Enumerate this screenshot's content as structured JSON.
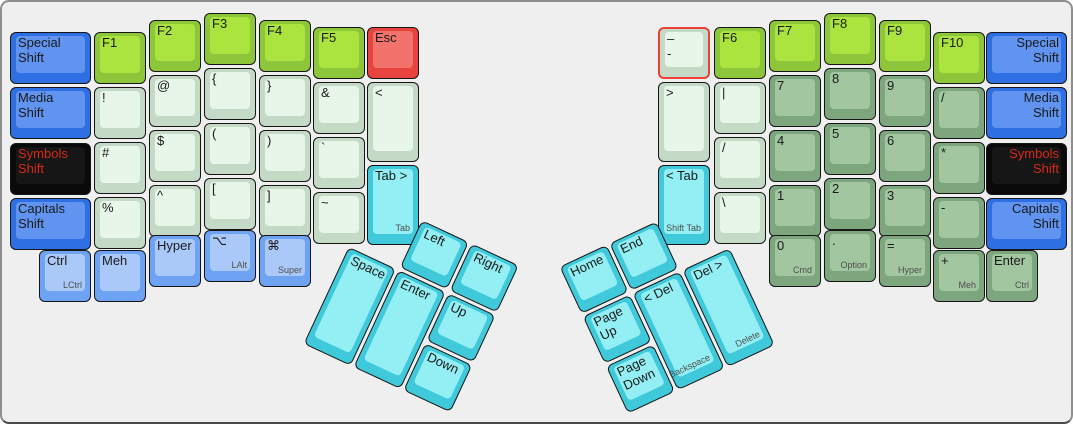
{
  "palette": {
    "fn": {
      "side": "#8dc63a",
      "cap": "#abe43e"
    },
    "pale": {
      "side": "#c5dac6",
      "cap": "#e7f6e9"
    },
    "sage": {
      "side": "#7ea67e",
      "cap": "#a2c7a0"
    },
    "blue": {
      "side": "#2e6fe4",
      "cap": "#6094f0"
    },
    "black": {
      "side": "#0a0a0a",
      "cap": "#161616",
      "text": "#d5291d"
    },
    "red": {
      "side": "#e8433e",
      "cap": "#f2736c"
    },
    "cyan": {
      "side": "#3fc9db",
      "cap": "#93eff3"
    },
    "lightblue": {
      "side": "#6ea3f3",
      "cap": "#abc9f8"
    },
    "selection": "#ee4035",
    "sublegend": "#4d4d4d",
    "canvas_bg": "#efefef"
  },
  "keyboard": {
    "groups": {
      "left_main": [
        {
          "name": "special-shift-left",
          "lines": [
            "Special",
            "Shift"
          ],
          "color": "blue"
        },
        {
          "name": "media-shift-left",
          "lines": [
            "Media",
            "Shift"
          ],
          "color": "blue"
        },
        {
          "name": "symbols-shift-left",
          "lines": [
            "Symbols",
            "Shift"
          ],
          "color": "black"
        },
        {
          "name": "capitals-shift-left",
          "lines": [
            "Capitals",
            "Shift"
          ],
          "color": "blue"
        },
        {
          "name": "f1",
          "lines": [
            "F1"
          ],
          "color": "fn"
        },
        {
          "name": "exclamation",
          "lines": [
            "!"
          ],
          "color": "pale"
        },
        {
          "name": "hash",
          "lines": [
            "#"
          ],
          "color": "pale"
        },
        {
          "name": "percent",
          "lines": [
            "%"
          ],
          "color": "pale"
        },
        {
          "name": "f2",
          "lines": [
            "F2"
          ],
          "color": "fn"
        },
        {
          "name": "at-sign",
          "lines": [
            "@"
          ],
          "color": "pale"
        },
        {
          "name": "dollar",
          "lines": [
            "$"
          ],
          "color": "pale"
        },
        {
          "name": "caret",
          "lines": [
            "^"
          ],
          "color": "pale"
        },
        {
          "name": "f3",
          "lines": [
            "F3"
          ],
          "color": "fn"
        },
        {
          "name": "brace-open",
          "lines": [
            "{"
          ],
          "color": "pale"
        },
        {
          "name": "paren-open",
          "lines": [
            "("
          ],
          "color": "pale"
        },
        {
          "name": "bracket-open",
          "lines": [
            "["
          ],
          "color": "pale"
        },
        {
          "name": "f4",
          "lines": [
            "F4"
          ],
          "color": "fn"
        },
        {
          "name": "brace-close",
          "lines": [
            "}"
          ],
          "color": "pale"
        },
        {
          "name": "paren-close",
          "lines": [
            ")"
          ],
          "color": "pale"
        },
        {
          "name": "bracket-close",
          "lines": [
            "]"
          ],
          "color": "pale"
        },
        {
          "name": "f5",
          "lines": [
            "F5"
          ],
          "color": "fn"
        },
        {
          "name": "ampersand",
          "lines": [
            "&"
          ],
          "color": "pale"
        },
        {
          "name": "backtick",
          "lines": [
            "`"
          ],
          "color": "pale"
        },
        {
          "name": "tilde",
          "lines": [
            "~"
          ],
          "color": "pale"
        },
        {
          "name": "esc",
          "lines": [
            "Esc"
          ],
          "color": "red"
        },
        {
          "name": "less-than",
          "lines": [
            "<"
          ],
          "color": "pale"
        },
        {
          "name": "tab",
          "lines": [
            "Tab >"
          ],
          "sub": "Tab",
          "color": "cyan"
        },
        {
          "name": "lctrl",
          "lines": [
            "Ctrl"
          ],
          "sub": "LCtrl",
          "color": "lightblue"
        },
        {
          "name": "meh",
          "lines": [
            "Meh"
          ],
          "color": "lightblue"
        },
        {
          "name": "hyper",
          "lines": [
            "Hyper"
          ],
          "color": "lightblue"
        },
        {
          "name": "lalt",
          "lines": [
            "⌥"
          ],
          "sub": "LAlt",
          "color": "lightblue"
        },
        {
          "name": "super",
          "lines": [
            "⌘"
          ],
          "sub": "Super",
          "color": "lightblue"
        }
      ],
      "right_main": [
        {
          "name": "dash",
          "lines": [
            "–",
            "-"
          ],
          "color": "pale",
          "selected": true
        },
        {
          "name": "greater-than",
          "lines": [
            ">"
          ],
          "color": "pale"
        },
        {
          "name": "shift-tab",
          "lines": [
            "< Tab"
          ],
          "sub": "Shift Tab",
          "color": "cyan"
        },
        {
          "name": "f6",
          "lines": [
            "F6"
          ],
          "color": "fn"
        },
        {
          "name": "pipe",
          "lines": [
            "|"
          ],
          "color": "pale"
        },
        {
          "name": "slash",
          "lines": [
            "/"
          ],
          "color": "pale"
        },
        {
          "name": "backslash",
          "lines": [
            "\\"
          ],
          "color": "pale"
        },
        {
          "name": "f7",
          "lines": [
            "F7"
          ],
          "color": "fn"
        },
        {
          "name": "num-7",
          "lines": [
            "7"
          ],
          "color": "sage"
        },
        {
          "name": "num-4",
          "lines": [
            "4"
          ],
          "color": "sage"
        },
        {
          "name": "num-1",
          "lines": [
            "1"
          ],
          "color": "sage"
        },
        {
          "name": "f8",
          "lines": [
            "F8"
          ],
          "color": "fn"
        },
        {
          "name": "num-8",
          "lines": [
            "8"
          ],
          "color": "sage"
        },
        {
          "name": "num-5",
          "lines": [
            "5"
          ],
          "color": "sage"
        },
        {
          "name": "num-2",
          "lines": [
            "2"
          ],
          "color": "sage"
        },
        {
          "name": "f9",
          "lines": [
            "F9"
          ],
          "color": "fn"
        },
        {
          "name": "num-9",
          "lines": [
            "9"
          ],
          "color": "sage"
        },
        {
          "name": "num-6",
          "lines": [
            "6"
          ],
          "color": "sage"
        },
        {
          "name": "num-3",
          "lines": [
            "3"
          ],
          "color": "sage"
        },
        {
          "name": "f10",
          "lines": [
            "F10"
          ],
          "color": "fn"
        },
        {
          "name": "num-slash",
          "lines": [
            "/"
          ],
          "color": "sage"
        },
        {
          "name": "num-asterisk",
          "lines": [
            "*"
          ],
          "color": "sage"
        },
        {
          "name": "num-minus",
          "lines": [
            "-"
          ],
          "color": "sage"
        },
        {
          "name": "special-shift-right",
          "lines": [
            "Special",
            "Shift"
          ],
          "color": "blue",
          "align": "right"
        },
        {
          "name": "media-shift-right",
          "lines": [
            "Media",
            "Shift"
          ],
          "color": "blue",
          "align": "right"
        },
        {
          "name": "symbols-shift-right",
          "lines": [
            "Symbols",
            "Shift"
          ],
          "color": "black",
          "align": "right"
        },
        {
          "name": "capitals-shift-right",
          "lines": [
            "Capitals",
            "Shift"
          ],
          "color": "blue",
          "align": "right"
        },
        {
          "name": "num-0-cmd",
          "lines": [
            "0"
          ],
          "sub": "Cmd",
          "color": "sage"
        },
        {
          "name": "dot-option",
          "lines": [
            "."
          ],
          "sub": "Option",
          "color": "sage"
        },
        {
          "name": "equals-hyper",
          "lines": [
            "="
          ],
          "sub": "Hyper",
          "color": "sage"
        },
        {
          "name": "plus-meh",
          "lines": [
            "+"
          ],
          "sub": "Meh",
          "color": "sage"
        },
        {
          "name": "enter-ctrl",
          "lines": [
            "Enter"
          ],
          "sub": "Ctrl",
          "color": "sage"
        }
      ],
      "left_thumb": [
        {
          "name": "arrow-left",
          "lines": [
            "Left"
          ],
          "color": "cyan"
        },
        {
          "name": "arrow-right",
          "lines": [
            "Right"
          ],
          "color": "cyan"
        },
        {
          "name": "space",
          "lines": [
            "Space"
          ],
          "color": "cyan"
        },
        {
          "name": "enter-thumb",
          "lines": [
            "Enter"
          ],
          "color": "cyan"
        },
        {
          "name": "arrow-up",
          "lines": [
            "Up"
          ],
          "color": "cyan"
        },
        {
          "name": "arrow-down",
          "lines": [
            "Down"
          ],
          "color": "cyan"
        }
      ],
      "right_thumb": [
        {
          "name": "home",
          "lines": [
            "Home"
          ],
          "color": "cyan"
        },
        {
          "name": "end",
          "lines": [
            "End"
          ],
          "color": "cyan"
        },
        {
          "name": "page-up",
          "lines": [
            "Page",
            "Up"
          ],
          "color": "cyan"
        },
        {
          "name": "page-down",
          "lines": [
            "Page",
            "Down"
          ],
          "color": "cyan"
        },
        {
          "name": "backspace-del",
          "lines": [
            "< Del"
          ],
          "sub": "Backspace",
          "color": "cyan"
        },
        {
          "name": "delete-del",
          "lines": [
            "Del >"
          ],
          "sub": "Delete",
          "color": "cyan"
        }
      ]
    }
  }
}
